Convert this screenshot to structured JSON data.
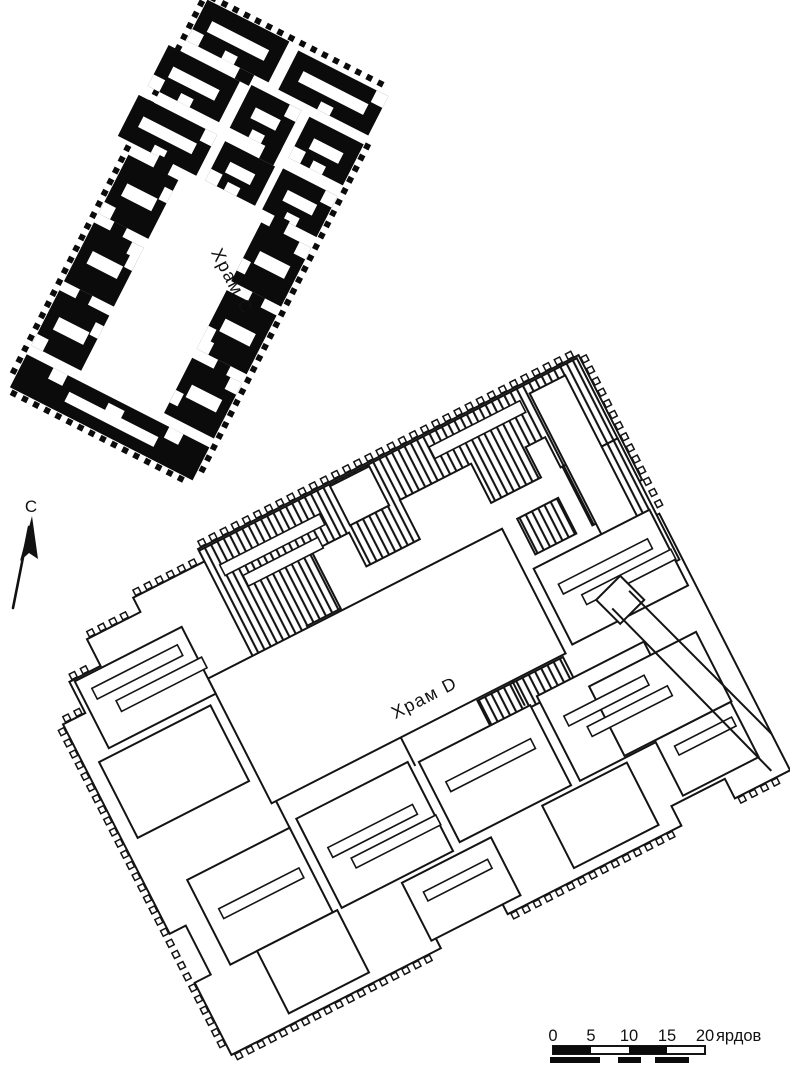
{
  "figure": {
    "type": "archaeological-site-plan",
    "background_color": "#ffffff",
    "ink_color": "#141414"
  },
  "labels": {
    "temple_c": "Храм С",
    "temple_d": "Храм D"
  },
  "north_indicator": {
    "label": "С"
  },
  "scale_bar": {
    "ticks": [
      "0",
      "5",
      "10",
      "15",
      "20"
    ],
    "unit": "ярдов",
    "segment_yards": 5,
    "total_yards": 20
  }
}
